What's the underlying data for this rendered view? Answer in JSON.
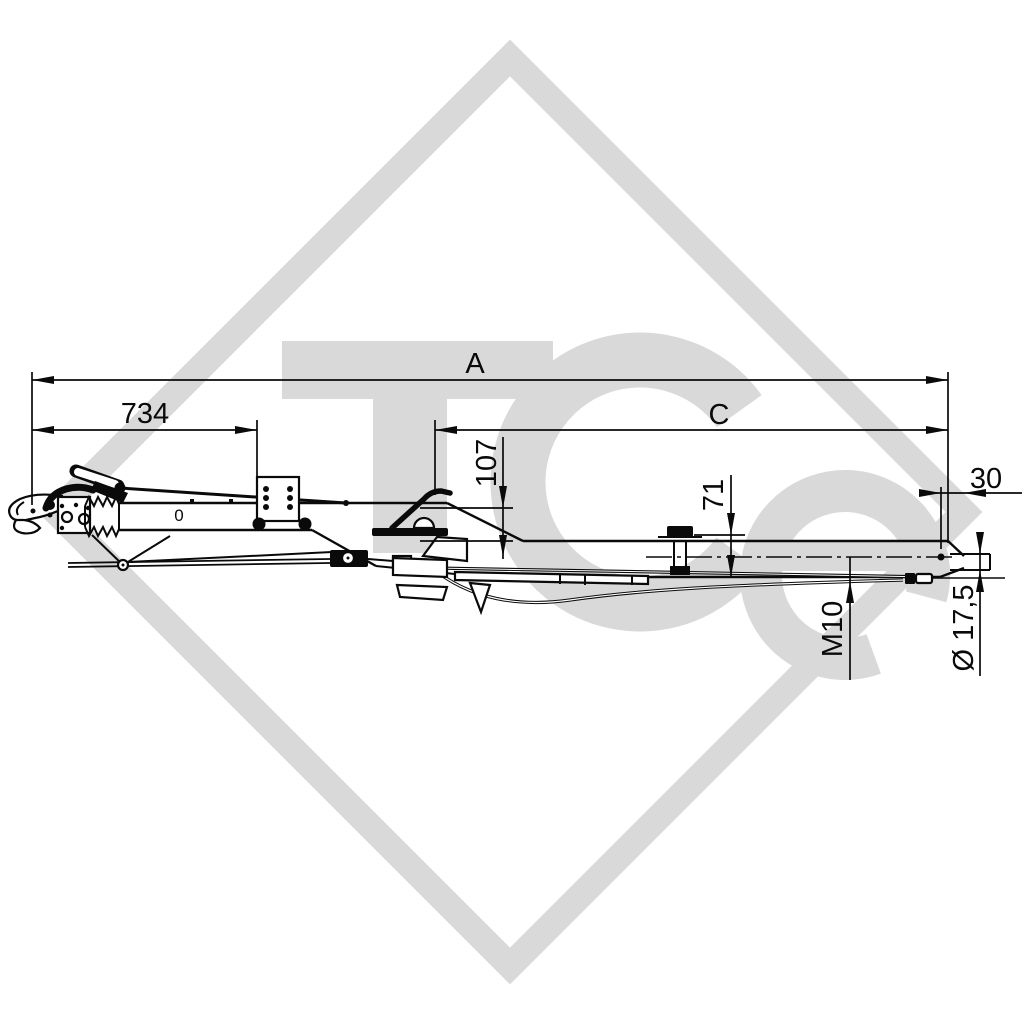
{
  "drawing": {
    "background": "#ffffff",
    "line_color": "#0a0a0a",
    "dimensions": {
      "overall_length": "A",
      "front_section_length": "734",
      "rear_section_length": "C",
      "height_107": "107",
      "height_71": "71",
      "end_offset": "30",
      "thread": "M10",
      "hole_diameter": "Ø 17,5"
    },
    "marks": {
      "tube_mark": "0"
    }
  },
  "watermark": {
    "text": "TCe",
    "color": "#d9d9d9"
  }
}
